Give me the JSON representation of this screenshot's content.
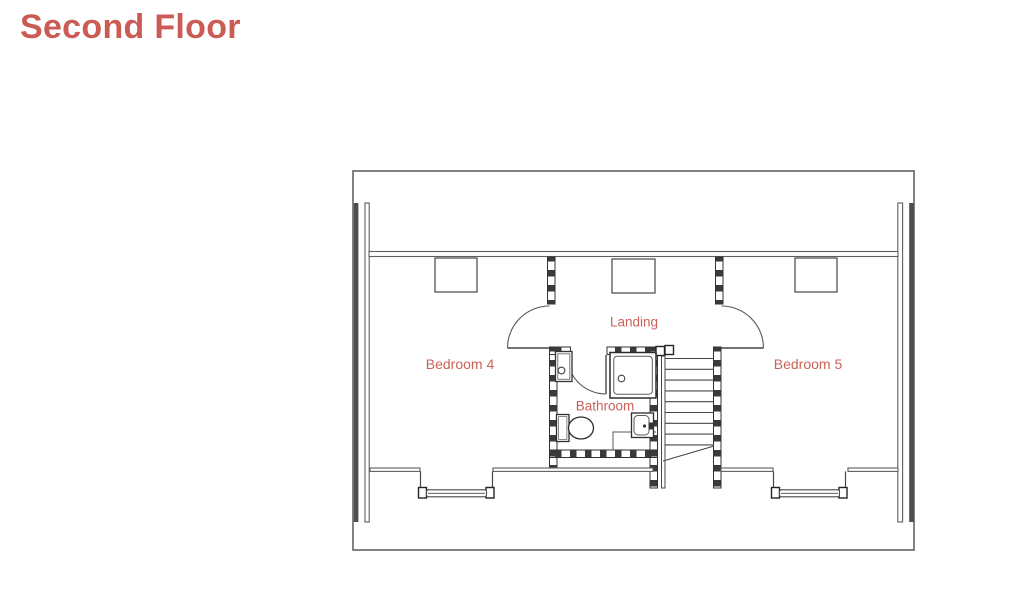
{
  "page": {
    "title": "Second Floor",
    "background_color": "#ffffff",
    "accent_color": "#cb5c55"
  },
  "floorplan": {
    "rooms": {
      "bedroom4": {
        "label": "Bedroom 4"
      },
      "bedroom5": {
        "label": "Bedroom 5"
      },
      "landing": {
        "label": "Landing"
      },
      "bathroom": {
        "label": "Bathroom"
      }
    },
    "fixtures": [
      "staircase",
      "shower",
      "toilet",
      "sink",
      "airing-cupboard",
      "chimney-breast",
      "dormer-window",
      "dormer-window"
    ],
    "colors": {
      "label": "#ca6159",
      "outline": "#5f5f5f",
      "wall_hatch": "#3a3a3a"
    }
  }
}
